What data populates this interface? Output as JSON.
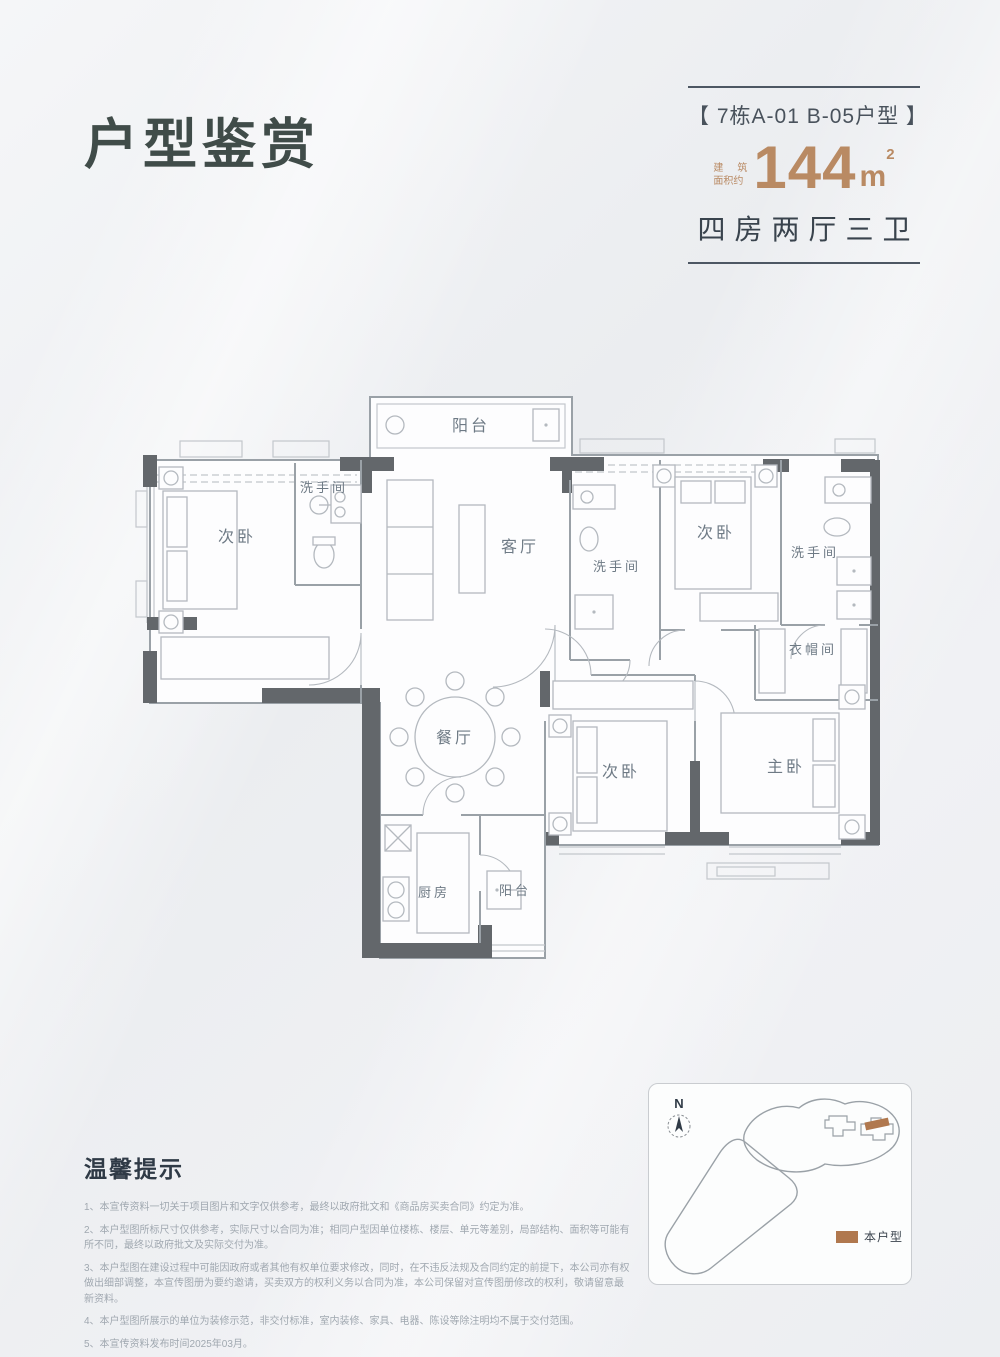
{
  "title": "户型鉴赏",
  "header": {
    "unit_label": "【 7栋A-01  B-05户型 】",
    "area_prefix_line1_a": "建",
    "area_prefix_line1_b": "筑",
    "area_prefix_line2": "面积约",
    "area_value": "144",
    "area_unit": "m",
    "area_sup": "2",
    "layout_text": "四房两厅三卫"
  },
  "floorplan": {
    "rooms": {
      "balcony_top": "阳台",
      "bath1": "洗手间",
      "bedroom1": "次卧",
      "living": "客厅",
      "bath2": "洗手间",
      "bedroom2": "次卧",
      "bath3": "洗手间",
      "cloakroom": "衣帽间",
      "dining": "餐厅",
      "bedroom3": "次卧",
      "master": "主卧",
      "kitchen": "厨房",
      "balcony_bottom": "阳台"
    }
  },
  "notes": {
    "title": "温馨提示",
    "items": [
      "1、本宣传资料一切关于项目图片和文字仅供参考，最终以政府批文和《商品房买卖合同》约定为准。",
      "2、本户型图所标尺寸仅供参考，实际尺寸以合同为准；相同户型因单位楼栋、楼层、单元等差别，局部结构、面积等可能有所不同，最终以政府批文及实际交付为准。",
      "3、本户型图在建设过程中可能因政府或者其他有权单位要求修改，同时，在不违反法规及合同约定的前提下，本公司亦有权做出细部调整，本宣传图册为要约邀请，买卖双方的权利义务以合同为准，本公司保留对宣传图册修改的权利，敬请留意最新资料。",
      "4、本户型图所展示的单位为装修示范，非交付标准，室内装修、家具、电器、陈设等除注明均不属于交付范围。",
      "5、本宣传资料发布时间2025年03月。"
    ]
  },
  "sitemap": {
    "compass": "N",
    "legend_label": "本户型"
  },
  "colors": {
    "accent_bronze": "#b98a63",
    "legend_brown": "#b0784e",
    "ink": "#39434d",
    "wall": "#63676b"
  }
}
